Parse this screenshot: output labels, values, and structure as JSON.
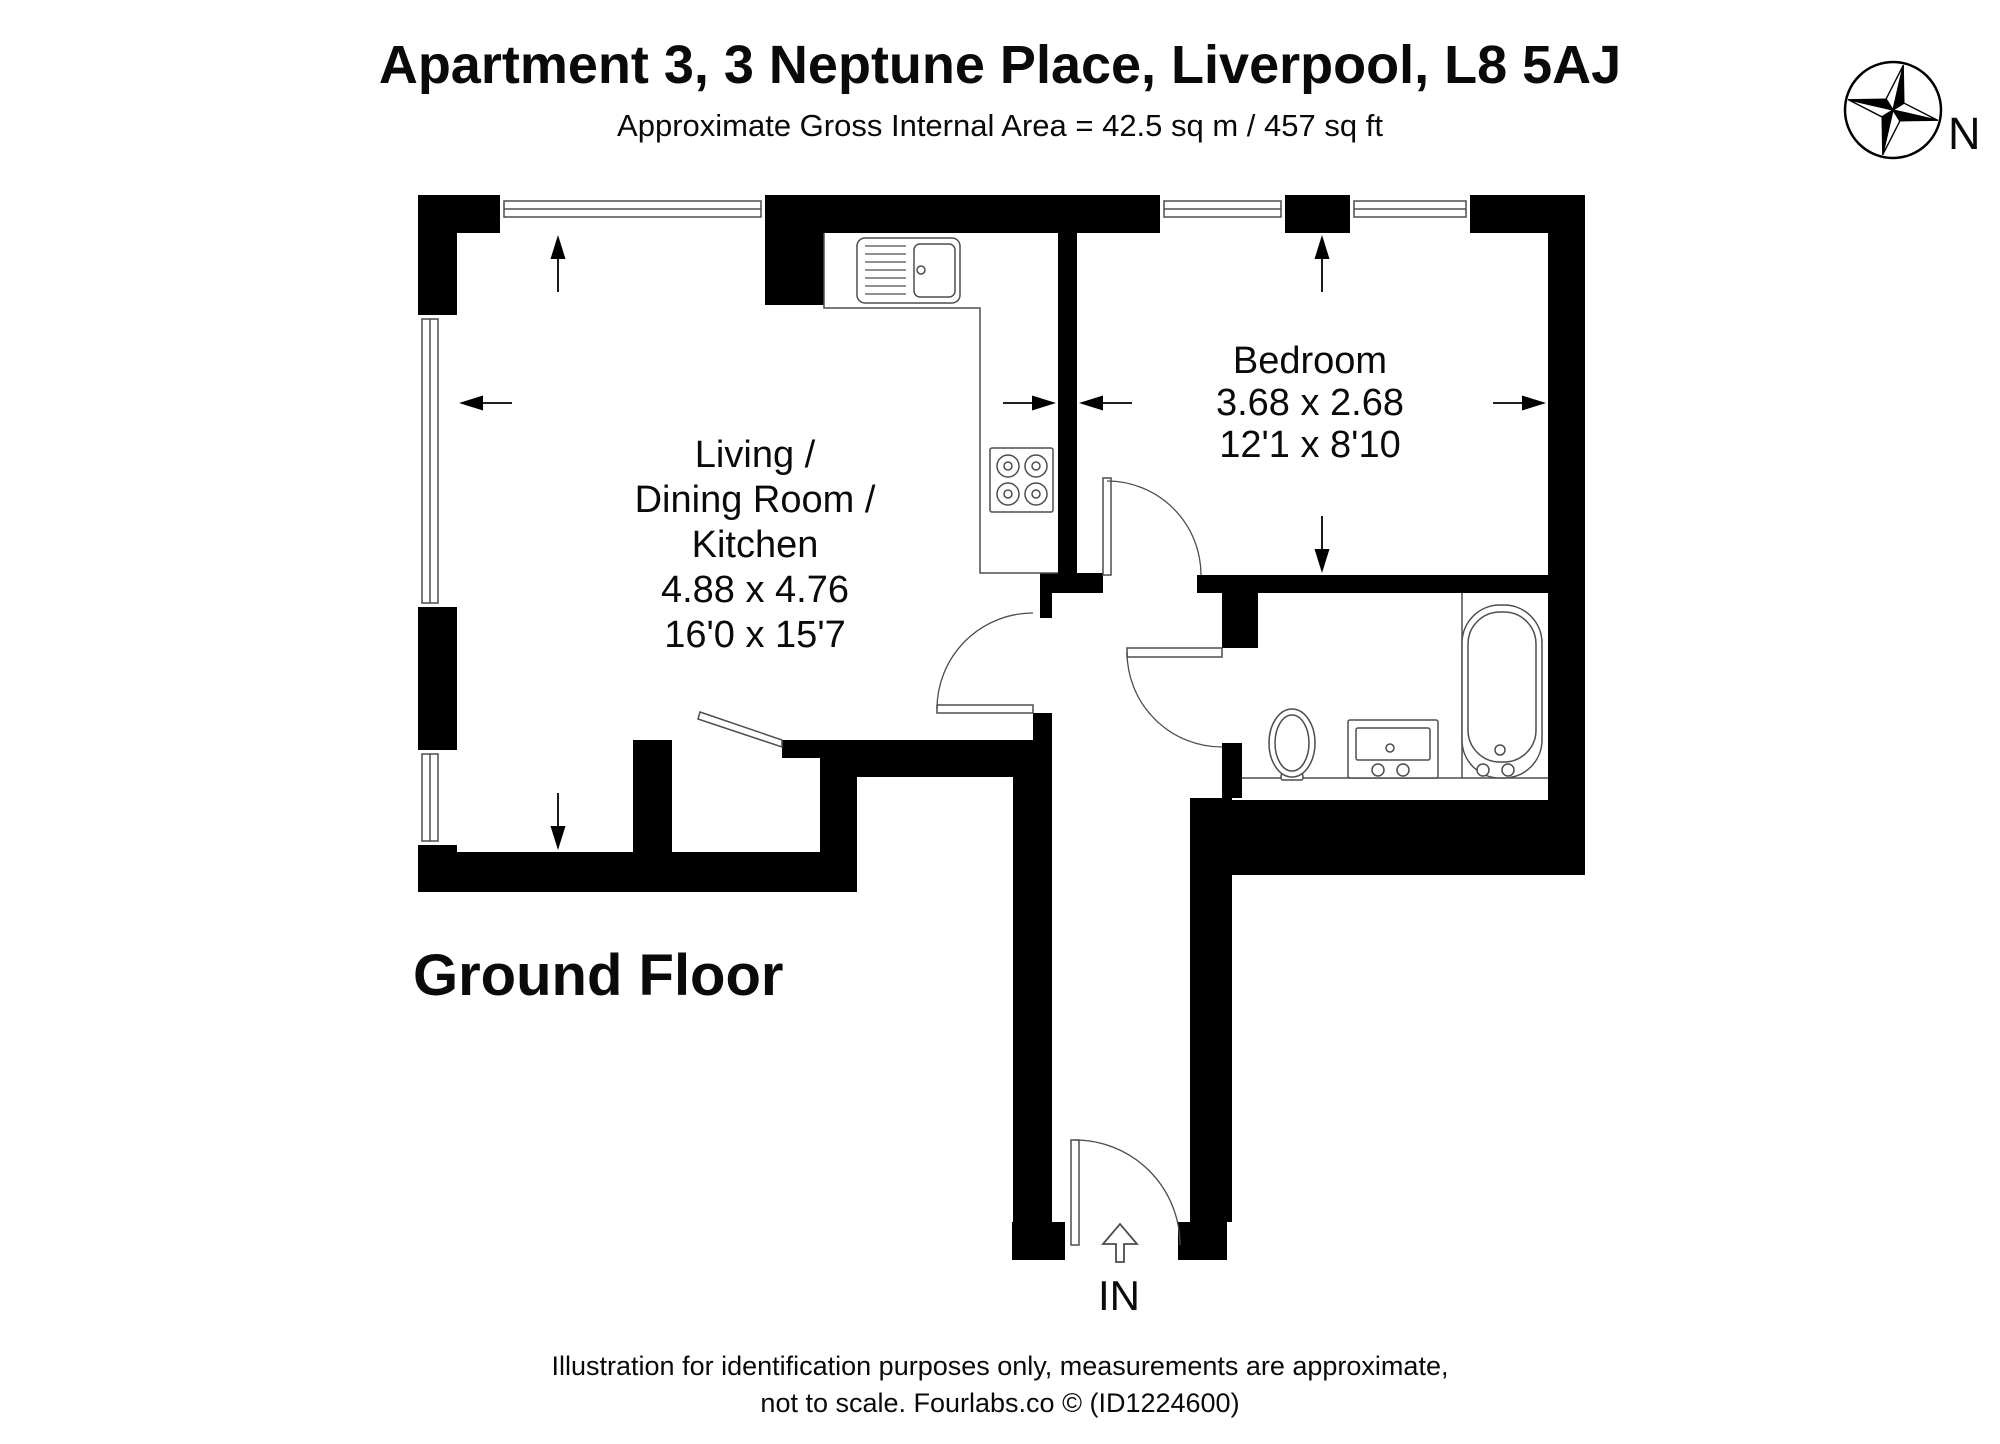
{
  "header": {
    "title": "Apartment 3, 3 Neptune Place, Liverpool, L8 5AJ",
    "subtitle": "Approximate Gross Internal Area = 42.5 sq m / 457 sq ft"
  },
  "compass": {
    "label": "N"
  },
  "floor": {
    "label": "Ground Floor"
  },
  "entrance": {
    "label": "IN"
  },
  "footer": {
    "line1": "Illustration for identification purposes only, measurements are approximate,",
    "line2": "not to scale. Fourlabs.co © (ID1224600)"
  },
  "rooms": [
    {
      "id": "living-dining-kitchen",
      "lines": [
        "Living /",
        "Dining Room /",
        "Kitchen",
        "4.88 x 4.76",
        "16'0 x 15'7"
      ]
    },
    {
      "id": "bedroom",
      "lines": [
        "Bedroom",
        "3.68 x 2.68",
        "12'1 x 8'10"
      ]
    }
  ],
  "plan": {
    "wall_color": "#000000",
    "fixture_color": "#4d4d4d",
    "walls": [
      [
        418,
        195,
        82,
        38
      ],
      [
        765,
        195,
        395,
        38
      ],
      [
        765,
        195,
        59,
        110
      ],
      [
        1285,
        195,
        65,
        38
      ],
      [
        1470,
        195,
        115,
        38
      ],
      [
        418,
        195,
        39,
        120
      ],
      [
        418,
        607,
        39,
        143
      ],
      [
        418,
        845,
        39,
        47
      ],
      [
        418,
        852,
        439,
        40
      ],
      [
        633,
        740,
        39,
        112
      ],
      [
        782,
        740,
        75,
        18
      ],
      [
        820,
        758,
        37,
        134
      ],
      [
        857,
        740,
        156,
        37
      ],
      [
        1013,
        740,
        39,
        482
      ],
      [
        1033,
        713,
        19,
        27
      ],
      [
        1012,
        1222,
        53,
        38
      ],
      [
        1058,
        233,
        19,
        340
      ],
      [
        1040,
        573,
        63,
        20
      ],
      [
        1040,
        593,
        12,
        25
      ],
      [
        1197,
        575,
        388,
        18
      ],
      [
        1548,
        195,
        37,
        380
      ],
      [
        1222,
        593,
        36,
        55
      ],
      [
        1222,
        743,
        20,
        55
      ],
      [
        1190,
        798,
        42,
        424
      ],
      [
        1178,
        1222,
        49,
        38
      ],
      [
        1230,
        800,
        355,
        75
      ],
      [
        1548,
        575,
        37,
        300
      ]
    ],
    "windows": [
      {
        "x": 500,
        "y": 196,
        "w": 265,
        "h": 36,
        "o": "h"
      },
      {
        "x": 1160,
        "y": 196,
        "w": 125,
        "h": 36,
        "o": "h"
      },
      {
        "x": 1350,
        "y": 196,
        "w": 120,
        "h": 36,
        "o": "h"
      },
      {
        "x": 419,
        "y": 315,
        "w": 38,
        "h": 292,
        "o": "v"
      },
      {
        "x": 419,
        "y": 750,
        "w": 38,
        "h": 95,
        "o": "v"
      }
    ],
    "doors": [
      {
        "leaf": [
          937,
          705,
          96,
          8
        ],
        "arc": "M 937 709 A 96 96 0 0 1 1033 613"
      },
      {
        "leaf": [
          1103,
          478,
          8,
          97
        ],
        "arc": "M 1107 481 A 94 94 0 0 1 1201 575"
      },
      {
        "leaf": [
          1127,
          648,
          95,
          9
        ],
        "arc": "M 1127 652 A 95 95 0 0 0 1222 747"
      },
      {
        "leaf": [
          1071,
          1140,
          8,
          105
        ],
        "arc": "M 1075 1140 A 105 105 0 0 1 1180 1245"
      },
      {
        "leaf_poly": "700,712 782,740 782,747 698,719"
      }
    ],
    "dim_arrows": [
      {
        "tip": [
          558,
          235
        ],
        "tail": [
          558,
          292
        ]
      },
      {
        "tip": [
          558,
          850
        ],
        "tail": [
          558,
          793
        ]
      },
      {
        "tip": [
          459,
          403
        ],
        "tail": [
          512,
          403
        ]
      },
      {
        "tip": [
          1056,
          403
        ],
        "tail": [
          1003,
          403
        ]
      },
      {
        "tip": [
          1322,
          235
        ],
        "tail": [
          1322,
          292
        ]
      },
      {
        "tip": [
          1322,
          573
        ],
        "tail": [
          1322,
          516
        ]
      },
      {
        "tip": [
          1079,
          403
        ],
        "tail": [
          1132,
          403
        ]
      },
      {
        "tip": [
          1546,
          403
        ],
        "tail": [
          1493,
          403
        ]
      }
    ],
    "entry_arrow": "1116,1262 1116,1244 1103,1244 1120,1224 1137,1244 1124,1244 1124,1262",
    "paths": [
      "M 824 233 L 824 308 L 980 308 L 980 573 L 1058 573",
      "M 1242 778 L 1548 778",
      "M 1462 593 L 1462 778"
    ],
    "rects": [
      {
        "x": 857,
        "y": 238,
        "w": 103,
        "h": 65,
        "rx": 8
      },
      {
        "x": 914,
        "y": 244,
        "w": 41,
        "h": 53,
        "rx": 6
      },
      {
        "x": 990,
        "y": 448,
        "w": 63,
        "h": 64,
        "rx": 2
      },
      {
        "x": 1348,
        "y": 720,
        "w": 90,
        "h": 58,
        "rx": 2
      },
      {
        "x": 1356,
        "y": 728,
        "w": 74,
        "h": 32,
        "rx": 2
      },
      {
        "x": 1462,
        "y": 605,
        "w": 80,
        "h": 173,
        "rx": 38
      },
      {
        "x": 1468,
        "y": 612,
        "w": 68,
        "h": 150,
        "rx": 32
      },
      {
        "x": 1281,
        "y": 774,
        "w": 22,
        "h": 6,
        "rx": 2
      }
    ],
    "circles": [
      {
        "cx": 921,
        "cy": 270,
        "r": 4
      },
      {
        "cx": 1008,
        "cy": 466,
        "r": 11
      },
      {
        "cx": 1036,
        "cy": 466,
        "r": 11
      },
      {
        "cx": 1008,
        "cy": 494,
        "r": 11
      },
      {
        "cx": 1036,
        "cy": 494,
        "r": 11
      },
      {
        "cx": 1008,
        "cy": 466,
        "r": 4
      },
      {
        "cx": 1036,
        "cy": 466,
        "r": 4
      },
      {
        "cx": 1008,
        "cy": 494,
        "r": 4
      },
      {
        "cx": 1036,
        "cy": 494,
        "r": 4
      },
      {
        "cx": 1390,
        "cy": 748,
        "r": 4
      },
      {
        "cx": 1378,
        "cy": 770,
        "r": 6
      },
      {
        "cx": 1403,
        "cy": 770,
        "r": 6
      },
      {
        "cx": 1483,
        "cy": 770,
        "r": 6
      },
      {
        "cx": 1508,
        "cy": 770,
        "r": 6
      },
      {
        "cx": 1500,
        "cy": 750,
        "r": 5
      }
    ],
    "ellipses": [
      {
        "cx": 1292,
        "cy": 743,
        "rx": 23,
        "ry": 34
      },
      {
        "cx": 1292,
        "cy": 743,
        "rx": 17,
        "ry": 28
      }
    ],
    "lines": [
      [
        865,
        246,
        906,
        246
      ],
      [
        865,
        254,
        906,
        254
      ],
      [
        865,
        262,
        906,
        262
      ],
      [
        865,
        270,
        906,
        270
      ],
      [
        865,
        278,
        906,
        278
      ],
      [
        865,
        286,
        906,
        286
      ],
      [
        865,
        294,
        906,
        294
      ]
    ],
    "compass": {
      "cx": 1893,
      "cy": 110,
      "r": 48,
      "rot": 13,
      "long": 46,
      "short": 13
    }
  }
}
